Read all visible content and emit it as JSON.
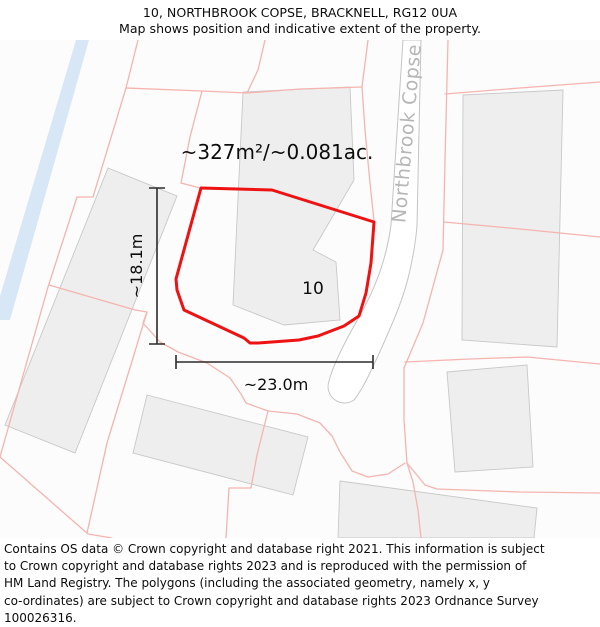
{
  "header": {
    "title": "10, NORTHBROOK COPSE, BRACKNELL, RG12 0UA",
    "subtitle": "Map shows position and indicative extent of the property."
  },
  "map": {
    "area_label": "~327m²/~0.081ac.",
    "plot_number": "10",
    "road_name": "Northbrook Copse",
    "width_label": "~23.0m",
    "height_label": "~18.1m",
    "colors": {
      "property_outline": "#ee1212",
      "parcel_line": "#f5b4af",
      "building_fill": "#eeeeee",
      "building_stroke": "#c8c8c8",
      "road_fill": "#ffffff",
      "road_stroke": "#c4c4c4",
      "water": "#d8e7f6",
      "dimension": "#2b2b2b",
      "road_label_color": "#b6b6b6",
      "map_background": "#fcfcfc"
    }
  },
  "footer": {
    "lines": [
      "Contains OS data © Crown copyright and database right 2021. This information is subject",
      "to Crown copyright and database rights 2023 and is reproduced with the permission of",
      "HM Land Registry. The polygons (including the associated geometry, namely x, y",
      "co-ordinates) are subject to Crown copyright and database rights 2023 Ordnance Survey",
      "100026316."
    ]
  }
}
